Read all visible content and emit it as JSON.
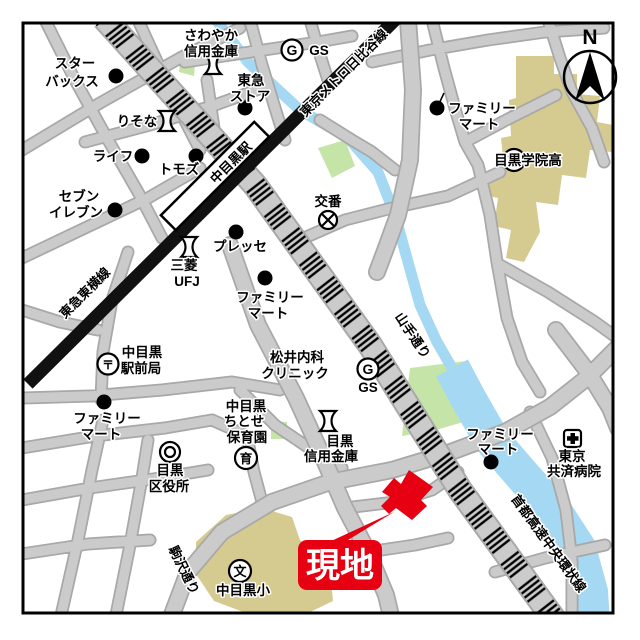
{
  "map": {
    "title": "中目黒駅周辺案内図",
    "compass_n": "N",
    "site_label": "現地",
    "railways": {
      "hibiya_line": "東京メトロ日比谷線",
      "toyoko_line": "東急東横線",
      "station": "中目黒駅"
    },
    "roads": {
      "yamate_dori": "山手通り",
      "shuto_expressway": "首都高速中央環状線",
      "komazawa_dori": "駒沢通り"
    },
    "symbols": {
      "gas": "G",
      "gas_text": "GS",
      "school": "文",
      "nursery": "育",
      "post": "〒",
      "koban": "交番"
    },
    "pois": {
      "starbucks": {
        "line1": "スター",
        "line2": "バックス"
      },
      "sawayaka_shinkin": {
        "line1": "さわやか",
        "line2": "信用金庫"
      },
      "gs_north": "GS",
      "tokyu_store": {
        "line1": "東急",
        "line2": "ストア"
      },
      "familymart_ne": {
        "line1": "ファミリー",
        "line2": "マート"
      },
      "meguro_gakuin": "目黒学院高",
      "risona": "りそな",
      "life": "ライフ",
      "tomods": "トモズ",
      "seven_eleven": {
        "line1": "セブン",
        "line2": "イレブン"
      },
      "koban": "交番",
      "presse": "プレッセ",
      "mufg": {
        "line1": "三菱",
        "line2": "UFJ"
      },
      "familymart_center": {
        "line1": "ファミリー",
        "line2": "マート"
      },
      "post_office": {
        "line1": "中目黒",
        "line2": "駅前局"
      },
      "matsui_clinic": {
        "line1": "松井内科",
        "line2": "クリニック"
      },
      "gs_mid": "GS",
      "familymart_west": {
        "line1": "ファミリー",
        "line2": "マート"
      },
      "ward_office": {
        "line1": "目黒",
        "line2": "区役所"
      },
      "chitose_hoikuen": {
        "line1": "中目黒",
        "line2": "ちとせ",
        "line3": "保育園"
      },
      "meguro_shinkin": {
        "line1": "目黒",
        "line2": "信用金庫"
      },
      "familymart_se": {
        "line1": "ファミリー",
        "line2": "マート"
      },
      "tokyo_kyosai": {
        "line1": "東京",
        "line2": "共済病院"
      },
      "nakameguro_elementary": "中目黒小"
    },
    "colors": {
      "road": "#cbcbcb",
      "road_casing": "#a8a8a8",
      "river": "#a5d8f2",
      "park": "#c5e5a8",
      "school_area": "#d5ca90",
      "railway": "#111111",
      "site_red": "#e60012"
    }
  }
}
